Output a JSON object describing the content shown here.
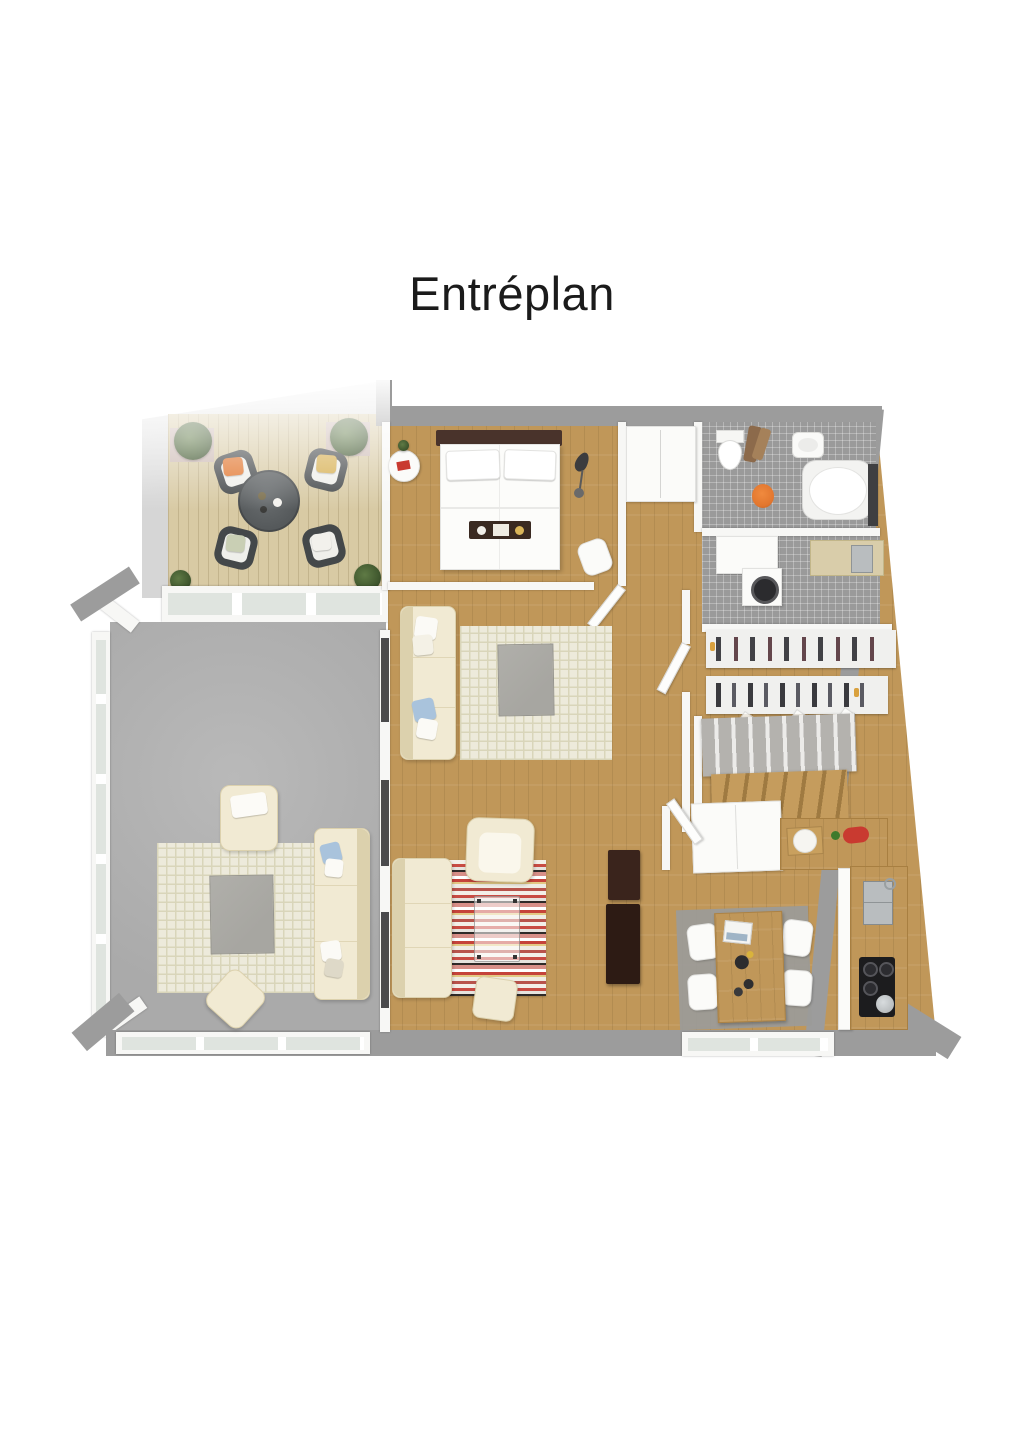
{
  "page": {
    "title": "Entréplan"
  },
  "palette": {
    "page_bg": "#ffffff",
    "title_color": "#1b1b1b",
    "outer_wall": "#9c9c9c",
    "exterior_pad": "#d6d6d6",
    "inner_wall": "#f7f7f5",
    "wall_edge": "#cfcfcd",
    "wood_floor": "#c09759",
    "wood_line": "#8c6a35",
    "deck_wood": "#d8caa4",
    "deck_line": "#b5a479",
    "concrete": "#aaaaaa",
    "tile": "#9a9a9a",
    "tile_line": "#c6c6c6",
    "rug_cream": "#edeadb",
    "rug_line": "#d9d5ba",
    "sofa_cream": "#f1ead3",
    "sofa_edge": "#dcd1ad",
    "table_gray": "#a7a6a1",
    "dark_wood": "#35211a",
    "headboard": "#49332b",
    "glass": "#dfe4df",
    "accent_orange": "#e2762e",
    "accent_red": "#c93a30",
    "accent_blue": "#a9c3dc",
    "accent_yellow": "#d6ae4e",
    "plant_green": "#41592f",
    "stair_carpet": "#b4b2ae",
    "steel": "#b9bdbf"
  }
}
